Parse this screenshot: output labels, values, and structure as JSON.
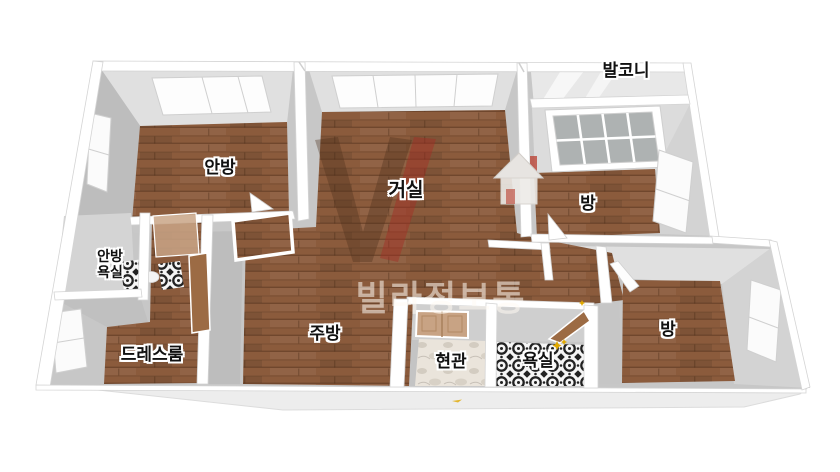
{
  "image": {
    "type": "3d-isometric-floor-plan",
    "background": "#ffffff"
  },
  "watermark": {
    "text": "빌라정보통"
  },
  "rooms": [
    {
      "id": "anbang",
      "label": "안방"
    },
    {
      "id": "geosil",
      "label": "거실"
    },
    {
      "id": "balcony",
      "label": "발코니"
    },
    {
      "id": "bang_top_right",
      "label": "방"
    },
    {
      "id": "bang_bottom_right",
      "label": "방"
    },
    {
      "id": "anbang_yoksil",
      "lines": [
        "안방",
        "욕실"
      ]
    },
    {
      "id": "dress_room",
      "label": "드레스룸"
    },
    {
      "id": "jubang",
      "label": "주방"
    },
    {
      "id": "hyeongwan",
      "label": "현관"
    },
    {
      "id": "yoksil",
      "label": "욕실"
    }
  ],
  "colors": {
    "wood": "#8b5b3c",
    "wood-dark": "#6e4326",
    "wall-top": "#ffffff",
    "wall-face": "#c7c7c7",
    "wall-face-light": "#e0e0e0",
    "wall-face-dark": "#bdbdbd",
    "balcony-floor": "#e8e8e8",
    "bath-gray": "#d4d4d4",
    "tile-ink": "#222222",
    "marble": "#eae4db",
    "window-pane": "#aeb2b2",
    "door-wood": "#9c6b44",
    "front-door": "#c8a384",
    "sparkle": "#e0a800",
    "slab": "#ededed",
    "watermark-brown": "rgba(75,45,25,0.35)",
    "watermark-red": "rgba(165,45,35,0.45)"
  }
}
